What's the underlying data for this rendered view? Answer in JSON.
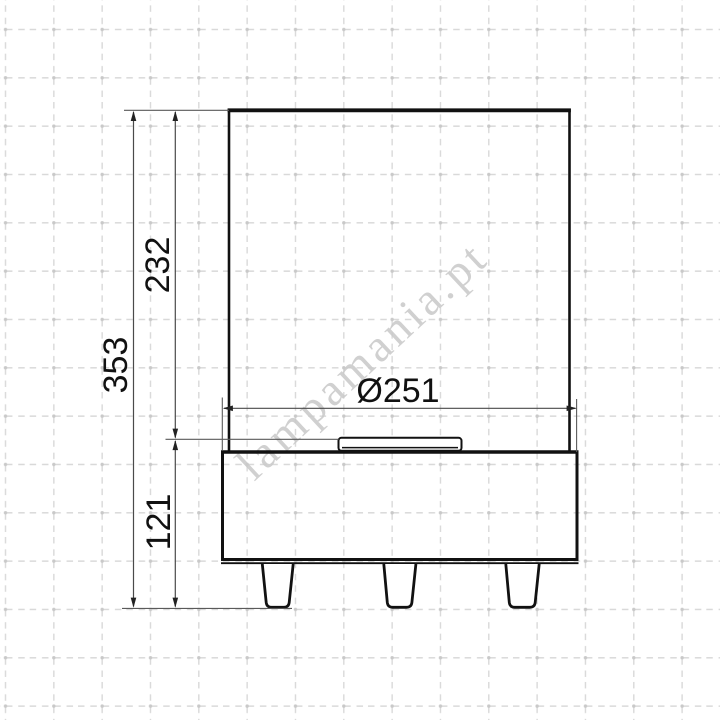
{
  "watermark": {
    "text": "lampamania.pt",
    "color": "#cbcbcb"
  },
  "drawing": {
    "type": "technical-dimension-drawing",
    "dimensions": {
      "total_height": {
        "label": "353",
        "orientation": "vertical"
      },
      "upper_height": {
        "label": "232",
        "orientation": "vertical"
      },
      "base_height": {
        "label": "121",
        "orientation": "vertical"
      },
      "diameter": {
        "label": "Ø251",
        "orientation": "horizontal"
      }
    },
    "colors": {
      "background": "#ffffff",
      "grid": "#d9d9d9",
      "grid_dot": "#c9c9c9",
      "outline": "#111111",
      "dimension": "#4a4a4a",
      "text": "#111111"
    }
  }
}
